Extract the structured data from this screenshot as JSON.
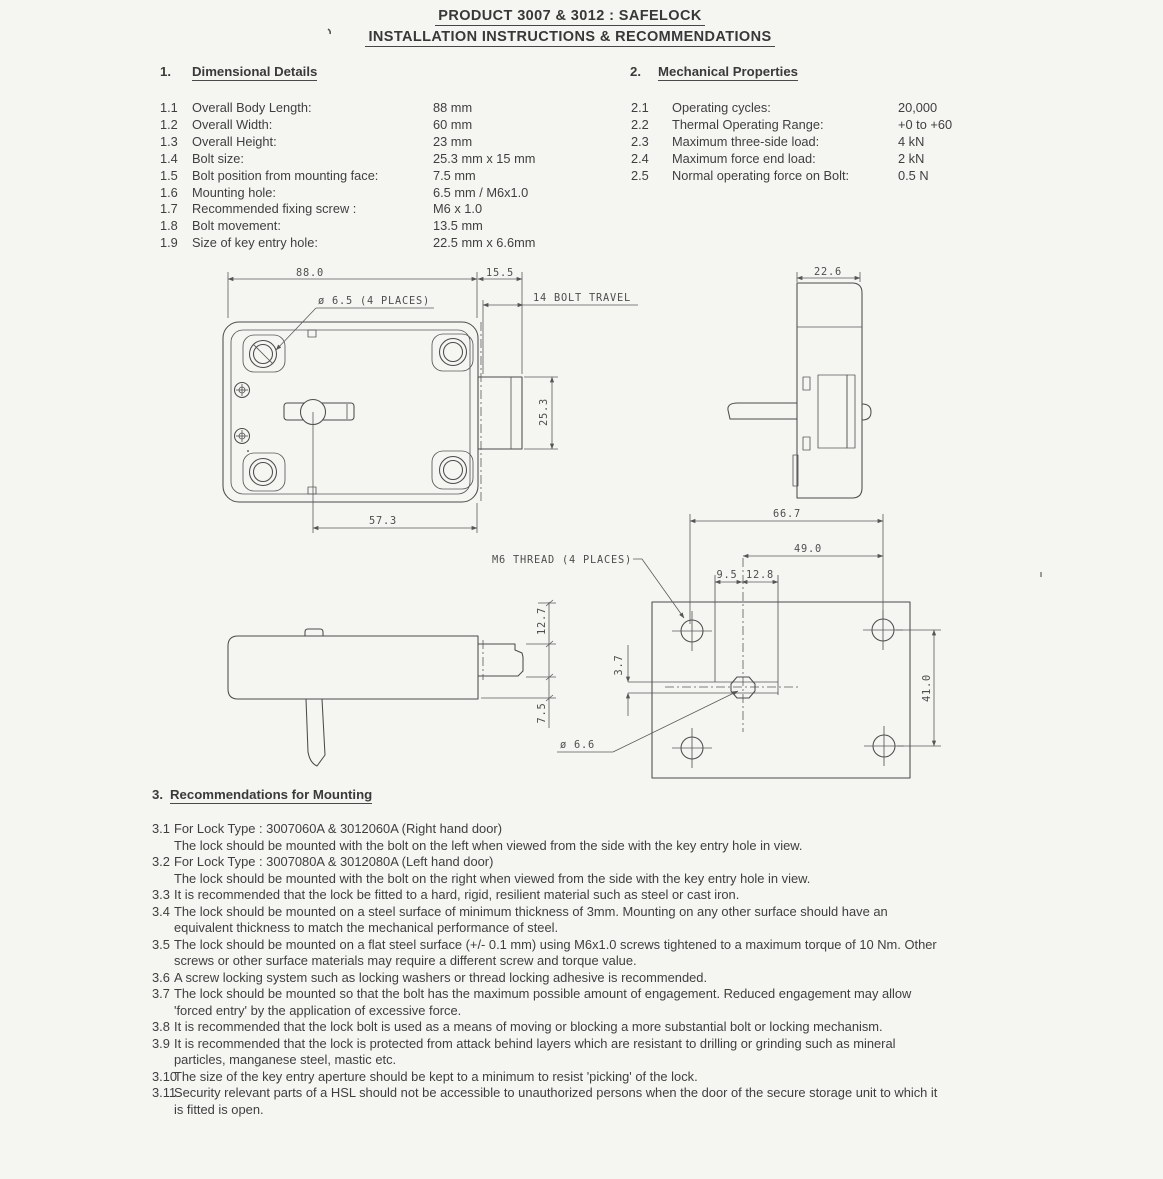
{
  "title": {
    "line1": "PRODUCT 3007 & 3012 : SAFELOCK",
    "line2": "INSTALLATION INSTRUCTIONS & RECOMMENDATIONS"
  },
  "section1": {
    "number": "1.",
    "heading": "Dimensional Details",
    "items": [
      {
        "num": "1.1",
        "label": "Overall Body Length:",
        "value": "88 mm"
      },
      {
        "num": "1.2",
        "label": "Overall Width:",
        "value": "60 mm"
      },
      {
        "num": "1.3",
        "label": "Overall Height:",
        "value": "23 mm"
      },
      {
        "num": "1.4",
        "label": "Bolt size:",
        "value": "25.3 mm x 15 mm"
      },
      {
        "num": "1.5",
        "label": "Bolt position from mounting face:",
        "value": "7.5 mm"
      },
      {
        "num": "1.6",
        "label": "Mounting hole:",
        "value": "6.5 mm / M6x1.0"
      },
      {
        "num": "1.7",
        "label": "Recommended fixing screw :",
        "value": "M6 x 1.0"
      },
      {
        "num": "1.8",
        "label": "Bolt movement:",
        "value": "13.5 mm"
      },
      {
        "num": "1.9",
        "label": "Size of key entry hole:",
        "value": "22.5 mm x 6.6mm"
      }
    ]
  },
  "section2": {
    "number": "2.",
    "heading": "Mechanical Properties",
    "items": [
      {
        "num": "2.1",
        "label": "Operating cycles:",
        "value": "20,000"
      },
      {
        "num": "2.2",
        "label": "Thermal Operating Range:",
        "value": "+0 to +60"
      },
      {
        "num": "2.3",
        "label": "Maximum three-side load:",
        "value": "4 kN"
      },
      {
        "num": "2.4",
        "label": "Maximum force end load:",
        "value": "2 kN"
      },
      {
        "num": "2.5",
        "label": "Normal operating force on Bolt:",
        "value": "0.5 N"
      }
    ]
  },
  "drawing": {
    "labels": {
      "dim_88": "88.0",
      "dim_15_5": "15.5",
      "bolt_travel": "14 BOLT TRAVEL",
      "holes_note": "ø 6.5 (4 PLACES)",
      "dim_25_3": "25.3",
      "dim_57_3": "57.3",
      "dim_22_6": "22.6",
      "dim_66_7": "66.7",
      "dim_49": "49.0",
      "dim_9_5": "9.5",
      "dim_12_8": "12.8",
      "thread_note": "M6 THREAD (4 PLACES)",
      "dim_3_7": "3.7",
      "dim_41": "41.0",
      "dia_6_6": "ø 6.6",
      "dim_12_7": "12.7",
      "dim_7_5": "7.5"
    }
  },
  "section3": {
    "number": "3.",
    "heading": "Recommendations for Mounting",
    "items": [
      {
        "num": "3.1",
        "lines": [
          "For Lock Type : 3007060A & 3012060A (Right hand door)",
          "The lock should be mounted with the bolt on the left when viewed from the side with the key entry hole in view."
        ]
      },
      {
        "num": "3.2",
        "lines": [
          "For Lock Type : 3007080A & 3012080A (Left hand door)",
          "The lock should be mounted with the bolt on the right when viewed from the side with the key entry hole in view."
        ]
      },
      {
        "num": "3.3",
        "lines": [
          "It is recommended that the lock be fitted to a hard, rigid, resilient material such as steel or cast iron."
        ]
      },
      {
        "num": "3.4",
        "lines": [
          "The lock should be mounted on a steel surface of minimum thickness of 3mm. Mounting on any other surface should have an",
          "equivalent thickness to match the mechanical performance of steel."
        ]
      },
      {
        "num": "3.5",
        "lines": [
          "The lock should be mounted on a flat steel surface (+/- 0.1 mm) using M6x1.0 screws tightened to a maximum torque of 10 Nm. Other",
          "screws or other surface materials may require a different screw and torque value."
        ]
      },
      {
        "num": "3.6",
        "lines": [
          "A screw locking system such as locking washers or thread locking adhesive is recommended."
        ]
      },
      {
        "num": "3.7",
        "lines": [
          "The lock should be mounted so that the bolt has the maximum possible amount of engagement. Reduced engagement may allow",
          "'forced entry' by the application of excessive force."
        ]
      },
      {
        "num": "3.8",
        "lines": [
          "It is recommended that the lock bolt is used as a means of moving or blocking a more substantial bolt or locking mechanism."
        ]
      },
      {
        "num": "3.9",
        "lines": [
          "It is recommended that the lock is protected from attack behind layers which are resistant to drilling or grinding such as mineral",
          "particles, manganese steel, mastic etc."
        ]
      },
      {
        "num": "3.10",
        "lines": [
          "The size of the key entry aperture should be kept to a minimum to resist 'picking' of the lock."
        ]
      },
      {
        "num": "3.11",
        "lines": [
          "Security relevant parts of a HSL should not be accessible to unauthorized persons when the door of the secure storage unit to which it",
          "is fitted is open."
        ]
      }
    ]
  }
}
